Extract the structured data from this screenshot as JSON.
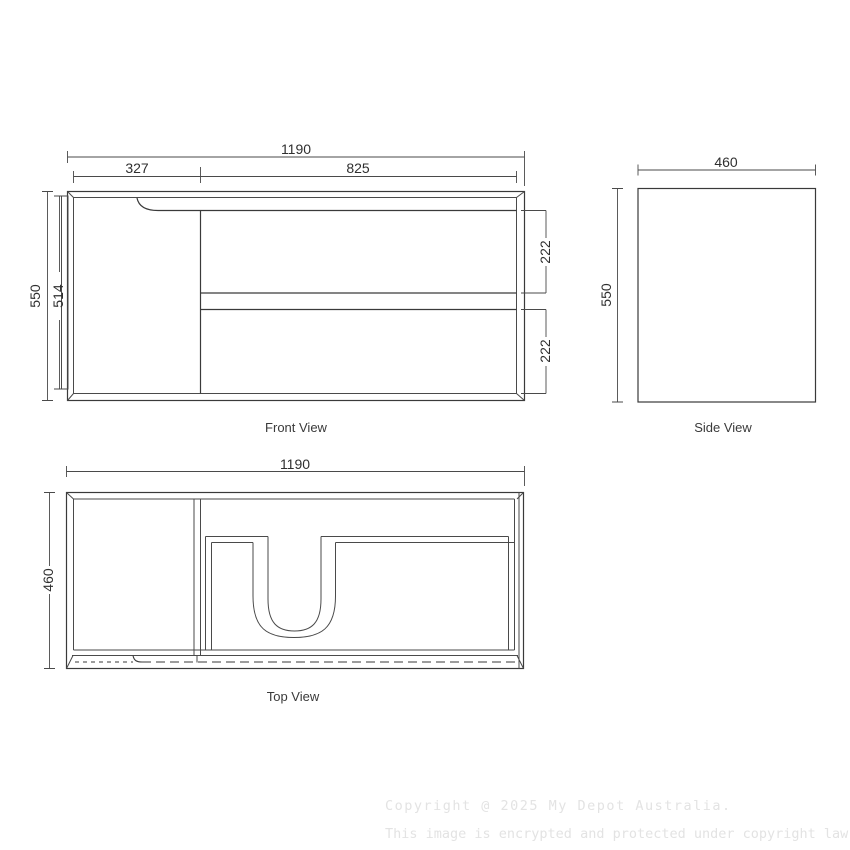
{
  "front_view": {
    "caption": "Front View",
    "dims": {
      "overall_width": "1190",
      "door_width": "327",
      "drawer_width": "825",
      "overall_height": "550",
      "door_height": "514",
      "top_drawer_height": "222",
      "bottom_drawer_height": "222"
    }
  },
  "side_view": {
    "caption": "Side View",
    "dims": {
      "depth": "460",
      "height": "550"
    }
  },
  "top_view": {
    "caption": "Top View",
    "dims": {
      "width": "1190",
      "depth": "460"
    }
  },
  "watermark": {
    "line1": "Copyright @ 2025 My Depot Australia.",
    "line2": "This image is encrypted and protected under copyright law."
  },
  "colors": {
    "line": "#3a3a3a",
    "dimension": "#4a4a4a",
    "text": "#2f2f2f",
    "watermark": "#e3e3e3",
    "background": "#ffffff"
  }
}
